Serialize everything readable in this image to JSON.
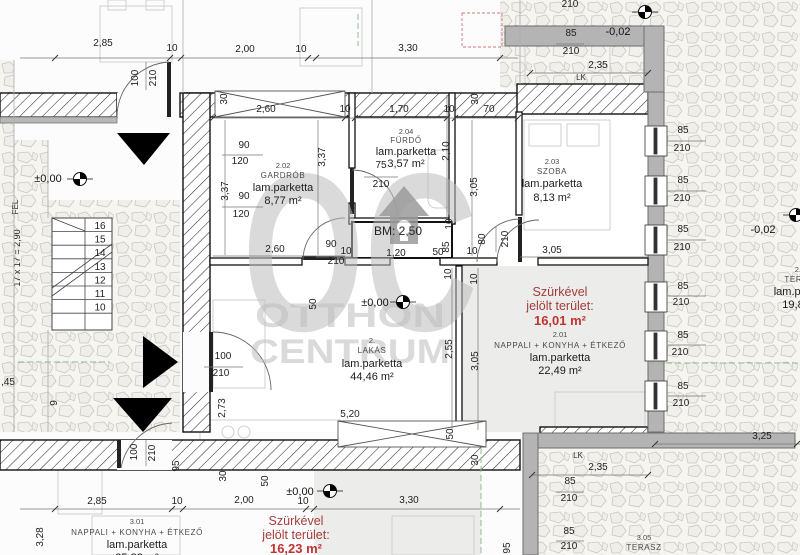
{
  "plan": {
    "watermark": {
      "logo": "OC",
      "line1": "OTTHON",
      "line2": "CENTRUM"
    },
    "labels": {
      "bm": "BM: 2,50",
      "lk": "LK"
    },
    "levels": {
      "zero": "±0,00",
      "minus": "-0,02"
    },
    "stairs": {
      "formula": "17 x 17 = 2,90",
      "direction": "FEL",
      "steps": [
        "16",
        "15",
        "14",
        "13",
        "12",
        "11",
        "10"
      ]
    },
    "rooms": {
      "gardrob": {
        "number": "2.02",
        "name": "GARDRÓB",
        "floor": "lam.parketta",
        "area": "8,77 m²"
      },
      "furdo": {
        "number": "2.04",
        "name": "FÜRDŐ",
        "floor": "lam.parketta",
        "area": "3,57 m²"
      },
      "szoba": {
        "number": "2.03",
        "name": "SZOBA",
        "floor": "lam.parketta",
        "area": "8,13 m²"
      },
      "lakas": {
        "number": "2.",
        "name": "LAKÁS",
        "floor": "lam.parketta",
        "area": "44,46 m²"
      },
      "nappali2": {
        "number": "2.01",
        "name": "NAPPALI + KONYHA + ÉTKEZŐ",
        "floor": "lam.parketta",
        "area": "22,49 m²"
      },
      "terasz2": {
        "number": "2.05",
        "name": "TERASZ",
        "floor": "lam.parketta",
        "area": "19,82 m²"
      },
      "nappali3": {
        "number": "3.01",
        "name": "NAPPALI + KONYHA + ÉTKEZŐ",
        "floor": "lam.parketta",
        "area": "25,82 m²"
      },
      "terasz3": {
        "number": "3.05",
        "name": "TERASZ"
      }
    },
    "highlight2": {
      "title1": "Szürkével",
      "title2": "jelölt terület:",
      "value": "16,01 m²"
    },
    "highlight3": {
      "title1": "Szürkével",
      "title2": "jelölt terület:",
      "value": "16,23 m²"
    },
    "dims": [
      {
        "t": "2,85",
        "x": 103,
        "y": 46
      },
      {
        "t": "10",
        "x": 172,
        "y": 51
      },
      {
        "t": "2,00",
        "x": 245,
        "y": 52
      },
      {
        "t": "10",
        "x": 301,
        "y": 52
      },
      {
        "t": "3,30",
        "x": 408,
        "y": 51
      },
      {
        "t": "100",
        "x": 138,
        "y": 78,
        "r": 1
      },
      {
        "t": "210",
        "x": 156,
        "y": 78,
        "r": 1
      },
      {
        "t": "30",
        "x": 227,
        "y": 99,
        "r": 1
      },
      {
        "t": "30",
        "x": 478,
        "y": 99,
        "r": 1
      },
      {
        "t": "210",
        "x": 570,
        "y": 7
      },
      {
        "t": "85",
        "x": 571,
        "y": 36
      },
      {
        "t": "210",
        "x": 571,
        "y": 54
      },
      {
        "t": "2,35",
        "x": 598,
        "y": 68
      },
      {
        "t": "2,60",
        "x": 266,
        "y": 112
      },
      {
        "t": "10",
        "x": 345,
        "y": 112
      },
      {
        "t": "1,70",
        "x": 399,
        "y": 112
      },
      {
        "t": "10",
        "x": 449,
        "y": 112
      },
      {
        "t": "70",
        "x": 489,
        "y": 112
      },
      {
        "t": "90",
        "x": 244,
        "y": 148
      },
      {
        "t": "120",
        "x": 240,
        "y": 164
      },
      {
        "t": "3,37",
        "x": 325,
        "y": 157,
        "r": 1
      },
      {
        "t": "3,37",
        "x": 228,
        "y": 191,
        "r": 1
      },
      {
        "t": "90",
        "x": 244,
        "y": 199
      },
      {
        "t": "120",
        "x": 241,
        "y": 217
      },
      {
        "t": "75",
        "x": 381,
        "y": 168
      },
      {
        "t": "210",
        "x": 381,
        "y": 187
      },
      {
        "t": "2,10",
        "x": 449,
        "y": 151,
        "r": 1
      },
      {
        "t": "3,05",
        "x": 477,
        "y": 187,
        "r": 1
      },
      {
        "t": "2,60",
        "x": 275,
        "y": 252
      },
      {
        "t": "90",
        "x": 331,
        "y": 247
      },
      {
        "t": "10",
        "x": 346,
        "y": 254
      },
      {
        "t": "210",
        "x": 336,
        "y": 264
      },
      {
        "t": "10",
        "x": 452,
        "y": 224,
        "r": 1
      },
      {
        "t": "85",
        "x": 449,
        "y": 247,
        "r": 1
      },
      {
        "t": "50",
        "x": 438,
        "y": 255
      },
      {
        "t": "1,20",
        "x": 396,
        "y": 256
      },
      {
        "t": "10",
        "x": 472,
        "y": 254
      },
      {
        "t": "80",
        "x": 485,
        "y": 239,
        "r": 1
      },
      {
        "t": "210",
        "x": 508,
        "y": 239,
        "r": 1
      },
      {
        "t": "10",
        "x": 451,
        "y": 274,
        "r": 1
      },
      {
        "t": "10",
        "x": 477,
        "y": 279,
        "r": 1
      },
      {
        "t": "3,05",
        "x": 552,
        "y": 253
      },
      {
        "t": "50",
        "x": 316,
        "y": 304,
        "r": 1
      },
      {
        "t": "85",
        "x": 683,
        "y": 133
      },
      {
        "t": "210",
        "x": 682,
        "y": 151
      },
      {
        "t": "85",
        "x": 683,
        "y": 183
      },
      {
        "t": "210",
        "x": 682,
        "y": 201
      },
      {
        "t": "85",
        "x": 683,
        "y": 232
      },
      {
        "t": "210",
        "x": 682,
        "y": 250
      },
      {
        "t": "85",
        "x": 683,
        "y": 289
      },
      {
        "t": "210",
        "x": 681,
        "y": 305
      },
      {
        "t": "85",
        "x": 683,
        "y": 338
      },
      {
        "t": "210",
        "x": 680,
        "y": 355
      },
      {
        "t": "85",
        "x": 683,
        "y": 389
      },
      {
        "t": "210",
        "x": 681,
        "y": 406
      },
      {
        "t": "2,55",
        "x": 452,
        "y": 349,
        "r": 1
      },
      {
        "t": "3,05",
        "x": 478,
        "y": 361,
        "r": 1
      },
      {
        "t": "100",
        "x": 223,
        "y": 359
      },
      {
        "t": "210",
        "x": 221,
        "y": 376
      },
      {
        "t": "2,73",
        "x": 225,
        "y": 408,
        "r": 1
      },
      {
        "t": "5,20",
        "x": 350,
        "y": 417
      },
      {
        "t": "50",
        "x": 453,
        "y": 434,
        "r": 1
      },
      {
        "t": "30",
        "x": 478,
        "y": 460,
        "r": 1
      },
      {
        "t": ",45",
        "x": 8,
        "y": 385
      },
      {
        "t": "9",
        "x": 57,
        "y": 403,
        "r": 1
      },
      {
        "t": "100",
        "x": 137,
        "y": 452,
        "r": 1
      },
      {
        "t": "210",
        "x": 155,
        "y": 453,
        "r": 1
      },
      {
        "t": "95",
        "x": 179,
        "y": 466,
        "r": 1
      },
      {
        "t": "30",
        "x": 226,
        "y": 476,
        "r": 1
      },
      {
        "t": "50",
        "x": 268,
        "y": 481,
        "r": 1
      },
      {
        "t": "2,85",
        "x": 97,
        "y": 504
      },
      {
        "t": "10",
        "x": 177,
        "y": 504
      },
      {
        "t": "2,00",
        "x": 244,
        "y": 503
      },
      {
        "t": "10",
        "x": 303,
        "y": 504
      },
      {
        "t": "3,30",
        "x": 409,
        "y": 503
      },
      {
        "t": "3,28",
        "x": 43,
        "y": 537,
        "r": 1
      },
      {
        "t": "95",
        "x": 510,
        "y": 548,
        "r": 1
      },
      {
        "t": "3,25",
        "x": 762,
        "y": 439
      },
      {
        "t": "2,35",
        "x": 598,
        "y": 470
      },
      {
        "t": "85",
        "x": 570,
        "y": 484
      },
      {
        "t": "210",
        "x": 569,
        "y": 501
      },
      {
        "t": "85",
        "x": 569,
        "y": 534
      },
      {
        "t": "210",
        "x": 569,
        "y": 549
      }
    ]
  }
}
